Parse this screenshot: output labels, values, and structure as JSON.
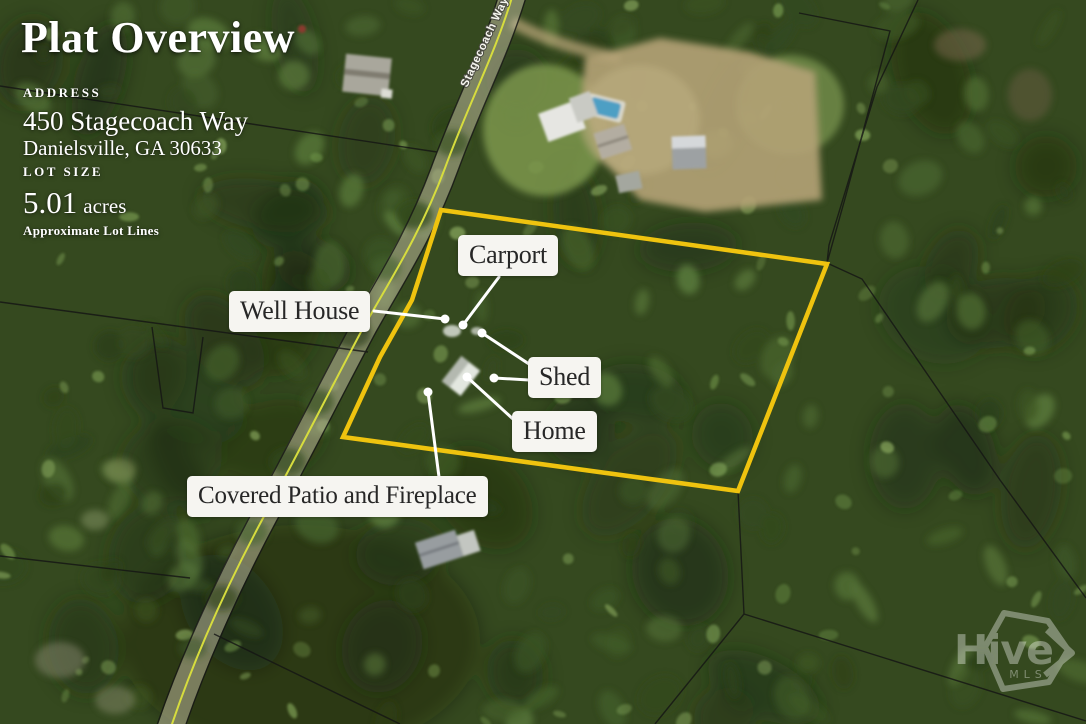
{
  "header": {
    "title": "Plat Overview"
  },
  "address": {
    "heading": "ADDRESS",
    "line1": "450 Stagecoach Way",
    "line2": "Danielsville, GA 30633"
  },
  "lot": {
    "heading": "LOT SIZE",
    "size": "5.01",
    "unit": "acres",
    "note": "Approximate Lot Lines"
  },
  "map": {
    "road_label": "Stagecoach Way",
    "callouts": [
      {
        "id": "carport",
        "label": "Carport"
      },
      {
        "id": "well-house",
        "label": "Well House"
      },
      {
        "id": "shed",
        "label": "Shed"
      },
      {
        "id": "home",
        "label": "Home"
      },
      {
        "id": "covered-patio",
        "label": "Covered Patio and Fireplace"
      }
    ],
    "colors": {
      "boundary": "#EFC30F",
      "road_centerline": "#D6DC3E",
      "parcel_line": "#141414",
      "leader": "#FFFFFF",
      "callout_bg": "#F6F5F1",
      "callout_text": "#272727"
    }
  },
  "watermark": {
    "brand": "Hive",
    "sub": "MLS"
  }
}
